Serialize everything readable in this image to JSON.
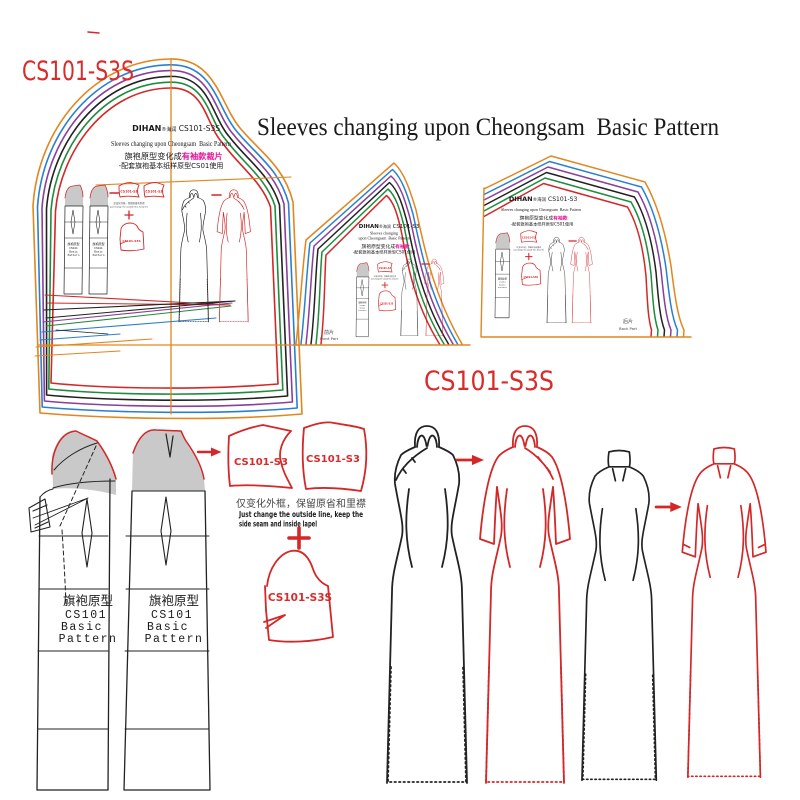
{
  "palette": {
    "red": "#d42727",
    "orange": "#e2861e",
    "blue": "#2a7fd0",
    "purple": "#8a3f9a",
    "green": "#1f8c3c",
    "black": "#222222",
    "magenta": "#e0189a",
    "gray_fill": "#c9c9c9"
  },
  "labels": {
    "top_code": "CS101-S3S",
    "title": "Sleeves changing upon Cheongsam  Basic Pattern",
    "mid_code": "CS101-S3S"
  },
  "big_pattern": {
    "brand": "DIHAN",
    "brand_suffix": "®海润",
    "code": " CS101-S3S",
    "subtitle": "Sleeves changing upon Cheongsam  Basic Pattern",
    "cn_black": "旗袍原型变化成",
    "cn_magenta": "有袖款裁片",
    "cn_line2": "-配套旗袍基本纸样原型CS01使用"
  },
  "front_pattern": {
    "brand": "DIHAN",
    "brand_suffix": "®海润",
    "code": " CS101-S3",
    "sub1": "Sleeves changing",
    "sub2": "upon Cheongsam  Basic Pattern",
    "cn_black": "旗袍原型变化成",
    "cn_magenta": "有袖款",
    "cn_line2": "-配套旗袍基本纸样原型CS01使用",
    "part_cn": "前片",
    "part_en": "Front Part"
  },
  "back_pattern": {
    "brand": "DIHAN",
    "brand_suffix": "®海润",
    "code": " CS101-S3",
    "subtitle": "Sleeves changing upon Cheongsam  Basic Pattern",
    "cn_black": "旗袍原型变化成",
    "cn_magenta": "有袖款",
    "cn_line2": "-配套旗袍基本纸样原型CS01使用",
    "part_cn": "后片",
    "part_en": "Back Part"
  },
  "basic_block": {
    "cn": "旗袍原型",
    "code": "CS101",
    "l3": "Basic",
    "l4": "Pattern"
  },
  "transform": {
    "piece_label": "CS101-S3",
    "caption_cn": "仅变化外框，保留原省和里襟",
    "caption_en1": "Just change the outside line, keep the",
    "caption_en2": "side seam and inside lapel",
    "plus": "+",
    "sleeve_label": "CS101-S3S"
  }
}
